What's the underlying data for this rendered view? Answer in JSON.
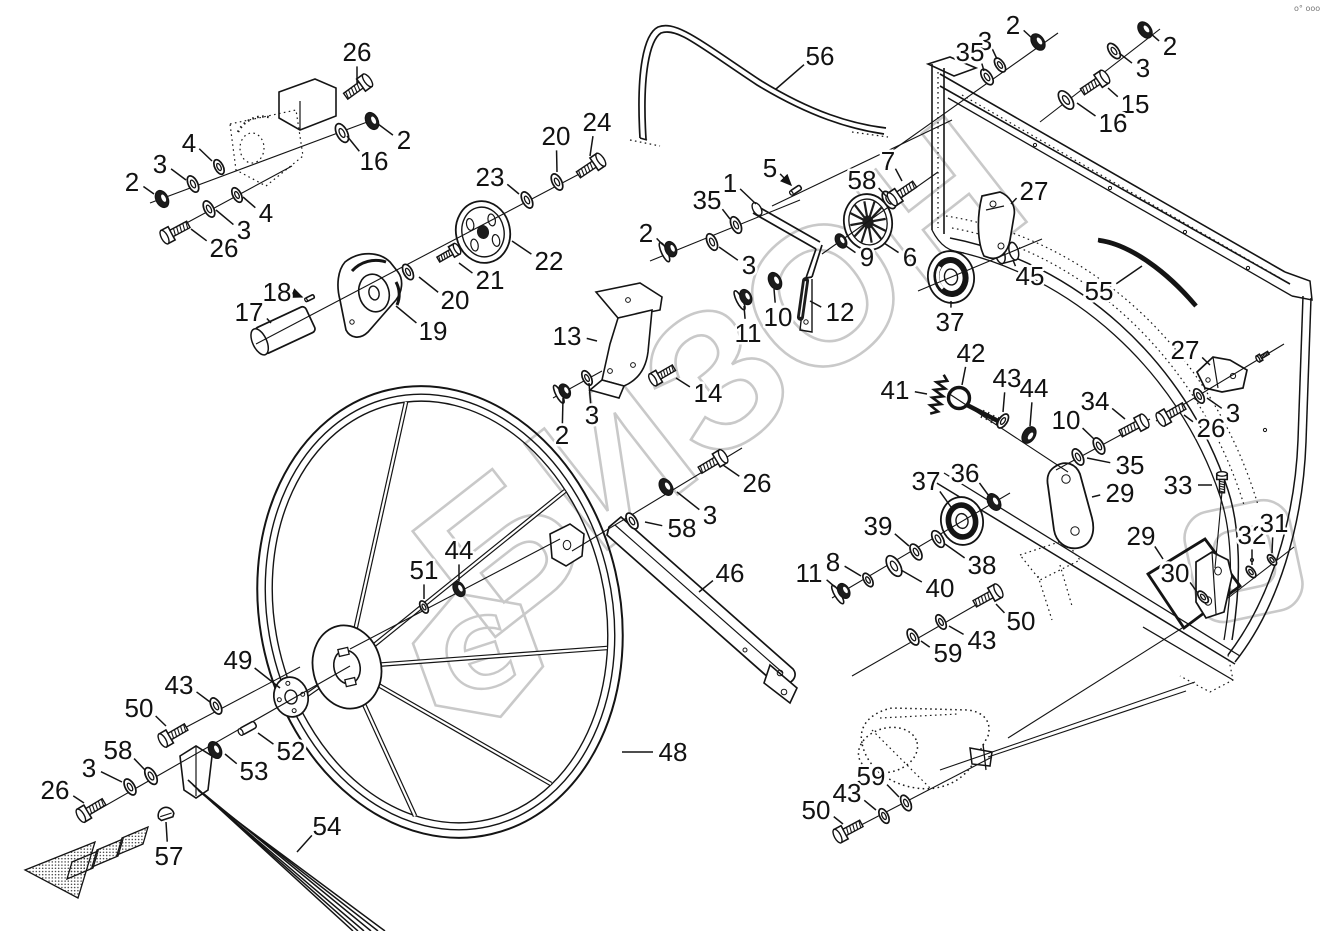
{
  "meta": {
    "type": "exploded-parts-diagram",
    "corner_mark": "o° ooo"
  },
  "watermark": {
    "text": "БИЗОН",
    "logo_glyph": "Є",
    "color": "#c9c9c9"
  },
  "colors": {
    "line": "#141414",
    "background": "#ffffff"
  },
  "labels": [
    {
      "t": "26",
      "x": 357,
      "y": 52,
      "px": 357,
      "py": 83
    },
    {
      "t": "2",
      "x": 404,
      "y": 140,
      "px": 378,
      "py": 124
    },
    {
      "t": "16",
      "x": 374,
      "y": 161,
      "px": 347,
      "py": 136
    },
    {
      "t": "4",
      "x": 189,
      "y": 143,
      "px": 212,
      "py": 161
    },
    {
      "t": "3",
      "x": 160,
      "y": 164,
      "px": 186,
      "py": 180
    },
    {
      "t": "2",
      "x": 132,
      "y": 182,
      "px": 154,
      "py": 194
    },
    {
      "t": "4",
      "x": 266,
      "y": 213,
      "px": 243,
      "py": 197
    },
    {
      "t": "3",
      "x": 244,
      "y": 230,
      "px": 216,
      "py": 210
    },
    {
      "t": "26",
      "x": 224,
      "y": 248,
      "px": 191,
      "py": 229
    },
    {
      "t": "17",
      "x": 249,
      "y": 312,
      "px": 271,
      "py": 323
    },
    {
      "t": "18",
      "x": 277,
      "y": 292,
      "px": 302,
      "py": 297,
      "arrow": true
    },
    {
      "t": "19",
      "x": 433,
      "y": 331,
      "px": 396,
      "py": 306
    },
    {
      "t": "20",
      "x": 455,
      "y": 300,
      "px": 419,
      "py": 277
    },
    {
      "t": "21",
      "x": 490,
      "y": 280,
      "px": 459,
      "py": 263
    },
    {
      "t": "22",
      "x": 549,
      "y": 261,
      "px": 512,
      "py": 241
    },
    {
      "t": "23",
      "x": 490,
      "y": 177,
      "px": 519,
      "py": 194
    },
    {
      "t": "20",
      "x": 556,
      "y": 136,
      "px": 557,
      "py": 172
    },
    {
      "t": "24",
      "x": 597,
      "y": 122,
      "px": 590,
      "py": 156
    },
    {
      "t": "56",
      "x": 820,
      "y": 56,
      "px": 776,
      "py": 89
    },
    {
      "t": "1",
      "x": 730,
      "y": 183,
      "px": 756,
      "py": 204
    },
    {
      "t": "5",
      "x": 770,
      "y": 168,
      "px": 791,
      "py": 185,
      "arrow": true
    },
    {
      "t": "35",
      "x": 707,
      "y": 200,
      "px": 730,
      "py": 219
    },
    {
      "t": "2",
      "x": 646,
      "y": 233,
      "px": 663,
      "py": 245
    },
    {
      "t": "3",
      "x": 749,
      "y": 265,
      "px": 719,
      "py": 247
    },
    {
      "t": "13",
      "x": 567,
      "y": 336,
      "px": 597,
      "py": 341
    },
    {
      "t": "14",
      "x": 708,
      "y": 393,
      "px": 676,
      "py": 378
    },
    {
      "t": "3",
      "x": 592,
      "y": 415,
      "px": 589,
      "py": 383
    },
    {
      "t": "2",
      "x": 562,
      "y": 435,
      "px": 563,
      "py": 398
    },
    {
      "t": "10",
      "x": 778,
      "y": 317,
      "px": 774,
      "py": 289
    },
    {
      "t": "11",
      "x": 748,
      "y": 333,
      "px": 744,
      "py": 306
    },
    {
      "t": "12",
      "x": 840,
      "y": 312,
      "px": 810,
      "py": 301
    },
    {
      "t": "58",
      "x": 862,
      "y": 180,
      "px": 886,
      "py": 196
    },
    {
      "t": "7",
      "x": 888,
      "y": 161,
      "px": 902,
      "py": 181
    },
    {
      "t": "9",
      "x": 867,
      "y": 257,
      "px": 846,
      "py": 246
    },
    {
      "t": "6",
      "x": 910,
      "y": 257,
      "px": 884,
      "py": 243
    },
    {
      "t": "37",
      "x": 950,
      "y": 322,
      "px": 951,
      "py": 301
    },
    {
      "t": "45",
      "x": 1030,
      "y": 276,
      "px": 1013,
      "py": 260
    },
    {
      "t": "27",
      "x": 1034,
      "y": 191,
      "px": 1011,
      "py": 204
    },
    {
      "t": "55",
      "x": 1099,
      "y": 291,
      "px": 1142,
      "py": 266
    },
    {
      "t": "2",
      "x": 1013,
      "y": 25,
      "px": 1033,
      "py": 39
    },
    {
      "t": "3",
      "x": 985,
      "y": 41,
      "px": 997,
      "py": 59
    },
    {
      "t": "35",
      "x": 970,
      "y": 52,
      "px": 984,
      "py": 71
    },
    {
      "t": "2",
      "x": 1170,
      "y": 46,
      "px": 1150,
      "py": 33
    },
    {
      "t": "3",
      "x": 1143,
      "y": 68,
      "px": 1119,
      "py": 53
    },
    {
      "t": "15",
      "x": 1135,
      "y": 104,
      "px": 1108,
      "py": 88
    },
    {
      "t": "16",
      "x": 1113,
      "y": 123,
      "px": 1077,
      "py": 103
    },
    {
      "t": "41",
      "x": 895,
      "y": 390,
      "px": 927,
      "py": 394
    },
    {
      "t": "42",
      "x": 971,
      "y": 353,
      "px": 962,
      "py": 385
    },
    {
      "t": "43",
      "x": 1007,
      "y": 378,
      "px": 1003,
      "py": 412
    },
    {
      "t": "44",
      "x": 1034,
      "y": 388,
      "px": 1030,
      "py": 426
    },
    {
      "t": "34",
      "x": 1095,
      "y": 401,
      "px": 1125,
      "py": 419
    },
    {
      "t": "10",
      "x": 1066,
      "y": 420,
      "px": 1094,
      "py": 439
    },
    {
      "t": "35",
      "x": 1130,
      "y": 465,
      "px": 1087,
      "py": 458
    },
    {
      "t": "36",
      "x": 965,
      "y": 473,
      "px": 989,
      "py": 496
    },
    {
      "t": "37",
      "x": 926,
      "y": 481,
      "px": 951,
      "py": 507
    },
    {
      "t": "29",
      "x": 1120,
      "y": 493,
      "px": 1092,
      "py": 497
    },
    {
      "t": "33",
      "x": 1178,
      "y": 485,
      "px": 1212,
      "py": 485
    },
    {
      "t": "27",
      "x": 1185,
      "y": 350,
      "px": 1210,
      "py": 365
    },
    {
      "t": "3",
      "x": 1233,
      "y": 413,
      "px": 1207,
      "py": 398
    },
    {
      "t": "26",
      "x": 1211,
      "y": 428,
      "px": 1184,
      "py": 415
    },
    {
      "t": "39",
      "x": 878,
      "y": 526,
      "px": 909,
      "py": 546
    },
    {
      "t": "38",
      "x": 982,
      "y": 565,
      "px": 945,
      "py": 544
    },
    {
      "t": "40",
      "x": 940,
      "y": 588,
      "px": 901,
      "py": 570
    },
    {
      "t": "8",
      "x": 833,
      "y": 562,
      "px": 861,
      "py": 576
    },
    {
      "t": "11",
      "x": 809,
      "y": 573,
      "px": 835,
      "py": 587
    },
    {
      "t": "50",
      "x": 1021,
      "y": 621,
      "px": 996,
      "py": 604
    },
    {
      "t": "43",
      "x": 982,
      "y": 640,
      "px": 949,
      "py": 626
    },
    {
      "t": "59",
      "x": 948,
      "y": 653,
      "px": 921,
      "py": 641
    },
    {
      "t": "29",
      "x": 1141,
      "y": 536,
      "px": 1163,
      "py": 559
    },
    {
      "t": "30",
      "x": 1175,
      "y": 573,
      "px": 1197,
      "py": 592
    },
    {
      "t": "32",
      "x": 1252,
      "y": 535,
      "px": 1252,
      "py": 565
    },
    {
      "t": "31",
      "x": 1274,
      "y": 523,
      "px": 1272,
      "py": 553
    },
    {
      "t": "51",
      "x": 424,
      "y": 570,
      "px": 424,
      "py": 599
    },
    {
      "t": "44",
      "x": 459,
      "y": 550,
      "px": 459,
      "py": 581
    },
    {
      "t": "58",
      "x": 682,
      "y": 528,
      "px": 645,
      "py": 522
    },
    {
      "t": "3",
      "x": 710,
      "y": 515,
      "px": 677,
      "py": 492
    },
    {
      "t": "26",
      "x": 757,
      "y": 483,
      "px": 723,
      "py": 465
    },
    {
      "t": "46",
      "x": 730,
      "y": 573,
      "px": 699,
      "py": 592
    },
    {
      "t": "48",
      "x": 673,
      "y": 752,
      "px": 622,
      "py": 752
    },
    {
      "t": "49",
      "x": 238,
      "y": 660,
      "px": 280,
      "py": 688
    },
    {
      "t": "43",
      "x": 179,
      "y": 685,
      "px": 210,
      "py": 702
    },
    {
      "t": "50",
      "x": 139,
      "y": 708,
      "px": 166,
      "py": 726
    },
    {
      "t": "58",
      "x": 118,
      "y": 750,
      "px": 145,
      "py": 770
    },
    {
      "t": "3",
      "x": 89,
      "y": 768,
      "px": 122,
      "py": 782
    },
    {
      "t": "26",
      "x": 55,
      "y": 790,
      "px": 84,
      "py": 803
    },
    {
      "t": "52",
      "x": 291,
      "y": 751,
      "px": 258,
      "py": 733
    },
    {
      "t": "53",
      "x": 254,
      "y": 771,
      "px": 225,
      "py": 754
    },
    {
      "t": "57",
      "x": 169,
      "y": 856,
      "px": 166,
      "py": 822
    },
    {
      "t": "54",
      "x": 327,
      "y": 826,
      "px": 297,
      "py": 852
    },
    {
      "t": "59",
      "x": 871,
      "y": 776,
      "px": 899,
      "py": 797
    },
    {
      "t": "43",
      "x": 847,
      "y": 793,
      "px": 876,
      "py": 810
    },
    {
      "t": "50",
      "x": 816,
      "y": 810,
      "px": 843,
      "py": 824
    }
  ],
  "axes": [
    [
      150,
      203,
      378,
      118
    ],
    [
      168,
      233,
      292,
      166
    ],
    [
      256,
      344,
      604,
      161
    ],
    [
      650,
      261,
      800,
      200
    ],
    [
      772,
      206,
      952,
      120
    ],
    [
      822,
      254,
      938,
      172
    ],
    [
      918,
      291,
      1042,
      239
    ],
    [
      893,
      150,
      1058,
      33
    ],
    [
      1040,
      122,
      1160,
      29
    ],
    [
      948,
      393,
      1068,
      472
    ],
    [
      1056,
      470,
      1150,
      419
    ],
    [
      832,
      598,
      1010,
      493
    ],
    [
      852,
      676,
      1002,
      590
    ],
    [
      1008,
      738,
      1198,
      618
    ],
    [
      838,
      837,
      992,
      757
    ],
    [
      988,
      757,
      1186,
      691
    ],
    [
      940,
      770,
      1195,
      682
    ],
    [
      82,
      819,
      350,
      666
    ],
    [
      160,
      741,
      300,
      667
    ],
    [
      350,
      649,
      560,
      539
    ],
    [
      572,
      551,
      742,
      448
    ],
    [
      553,
      398,
      602,
      371
    ],
    [
      1222,
      492,
      1215,
      568
    ],
    [
      1228,
      598,
      1294,
      547
    ],
    [
      1156,
      421,
      1284,
      344
    ]
  ],
  "hardware": [
    {
      "k": "n",
      "x": 162,
      "y": 199,
      "a": -27
    },
    {
      "k": "w",
      "x": 193,
      "y": 184,
      "a": -27
    },
    {
      "k": "w",
      "x": 219,
      "y": 167,
      "a": -27,
      "s": 0.9
    },
    {
      "k": "w",
      "x": 342,
      "y": 133,
      "a": -27,
      "s": 1.15
    },
    {
      "k": "n",
      "x": 372,
      "y": 121,
      "a": -27
    },
    {
      "k": "b",
      "x": 357,
      "y": 88,
      "a": 144
    },
    {
      "k": "b",
      "x": 176,
      "y": 231,
      "a": -28
    },
    {
      "k": "w",
      "x": 209,
      "y": 209,
      "a": -28
    },
    {
      "k": "w",
      "x": 237,
      "y": 195,
      "a": -28,
      "s": 0.9
    },
    {
      "k": "w",
      "x": 408,
      "y": 272,
      "a": -28,
      "s": 0.95
    },
    {
      "k": "b",
      "x": 448,
      "y": 254,
      "a": 150,
      "s": 0.8
    },
    {
      "k": "w",
      "x": 527,
      "y": 200,
      "a": -28
    },
    {
      "k": "w",
      "x": 557,
      "y": 182,
      "a": -28
    },
    {
      "k": "b",
      "x": 590,
      "y": 167,
      "a": 146
    },
    {
      "k": "f",
      "x": 669,
      "y": 250,
      "a": -25
    },
    {
      "k": "w",
      "x": 712,
      "y": 242,
      "a": -25
    },
    {
      "k": "w",
      "x": 736,
      "y": 225,
      "a": -25
    },
    {
      "k": "f",
      "x": 563,
      "y": 392,
      "a": -28,
      "s": 0.95
    },
    {
      "k": "w",
      "x": 587,
      "y": 378,
      "a": -28,
      "s": 0.9
    },
    {
      "k": "b",
      "x": 663,
      "y": 374,
      "a": -30,
      "s": 0.9
    },
    {
      "k": "n",
      "x": 775,
      "y": 281,
      "a": -27
    },
    {
      "k": "f",
      "x": 744,
      "y": 298,
      "a": -27
    },
    {
      "k": "p",
      "x": 796,
      "y": 190,
      "a": -34,
      "s": 0.7
    },
    {
      "k": "p",
      "x": 310,
      "y": 298,
      "a": -26,
      "s": 0.55
    },
    {
      "k": "sp",
      "x": 803,
      "y": 299
    },
    {
      "k": "w",
      "x": 889,
      "y": 200,
      "a": -33,
      "s": 1.1
    },
    {
      "k": "b",
      "x": 903,
      "y": 192,
      "a": -34
    },
    {
      "k": "n",
      "x": 841,
      "y": 241,
      "a": -30,
      "s": 0.85
    },
    {
      "k": "w",
      "x": 987,
      "y": 77,
      "a": -34
    },
    {
      "k": "w",
      "x": 1000,
      "y": 65,
      "a": -34,
      "s": 0.9
    },
    {
      "k": "n",
      "x": 1038,
      "y": 42,
      "a": -34
    },
    {
      "k": "w",
      "x": 1066,
      "y": 100,
      "a": -36,
      "s": 1.2
    },
    {
      "k": "b",
      "x": 1094,
      "y": 84,
      "a": 146
    },
    {
      "k": "w",
      "x": 1114,
      "y": 51,
      "a": -36
    },
    {
      "k": "n",
      "x": 1145,
      "y": 30,
      "a": -36
    },
    {
      "k": "w",
      "x": 1003,
      "y": 421,
      "a": 33,
      "s": 0.9
    },
    {
      "k": "n",
      "x": 1029,
      "y": 435,
      "a": 33
    },
    {
      "k": "w",
      "x": 1078,
      "y": 457,
      "a": -28
    },
    {
      "k": "w",
      "x": 1099,
      "y": 446,
      "a": -28
    },
    {
      "k": "b",
      "x": 1133,
      "y": 427,
      "a": 152
    },
    {
      "k": "coil",
      "x": 938,
      "y": 396,
      "a": 105
    },
    {
      "k": "n",
      "x": 994,
      "y": 502,
      "a": -31
    },
    {
      "k": "f",
      "x": 842,
      "y": 592,
      "a": -31
    },
    {
      "k": "w",
      "x": 868,
      "y": 580,
      "a": -31,
      "s": 0.85
    },
    {
      "k": "w",
      "x": 894,
      "y": 566,
      "a": -31,
      "s": 1.3
    },
    {
      "k": "w",
      "x": 916,
      "y": 552,
      "a": -31
    },
    {
      "k": "w",
      "x": 938,
      "y": 539,
      "a": -31,
      "s": 1.05
    },
    {
      "k": "w",
      "x": 913,
      "y": 637,
      "a": -29
    },
    {
      "k": "w",
      "x": 941,
      "y": 622,
      "a": -29,
      "s": 0.9
    },
    {
      "k": "b",
      "x": 987,
      "y": 597,
      "a": 151
    },
    {
      "k": "b",
      "x": 1222,
      "y": 483,
      "a": 90,
      "s": 0.7
    },
    {
      "k": "w",
      "x": 1251,
      "y": 572,
      "a": -38,
      "s": 0.75
    },
    {
      "k": "w",
      "x": 1272,
      "y": 560,
      "a": -38,
      "s": 0.7
    },
    {
      "k": "w",
      "x": 1203,
      "y": 597,
      "a": -40,
      "s": 0.8
    },
    {
      "k": "b",
      "x": 1172,
      "y": 413,
      "a": -30
    },
    {
      "k": "w",
      "x": 1199,
      "y": 396,
      "a": -30,
      "s": 0.9
    },
    {
      "k": "b",
      "x": 1263,
      "y": 356,
      "a": -31,
      "s": 0.45
    },
    {
      "k": "b",
      "x": 849,
      "y": 830,
      "a": -28
    },
    {
      "k": "w",
      "x": 884,
      "y": 816,
      "a": -27,
      "s": 0.9
    },
    {
      "k": "w",
      "x": 906,
      "y": 803,
      "a": -27,
      "s": 0.95
    },
    {
      "k": "b",
      "x": 92,
      "y": 809,
      "a": -31
    },
    {
      "k": "w",
      "x": 130,
      "y": 787,
      "a": -30
    },
    {
      "k": "w",
      "x": 151,
      "y": 776,
      "a": -30,
      "s": 1.05
    },
    {
      "k": "b",
      "x": 174,
      "y": 734,
      "a": -30
    },
    {
      "k": "w",
      "x": 216,
      "y": 706,
      "a": -28
    },
    {
      "k": "n",
      "x": 215,
      "y": 750,
      "a": -28
    },
    {
      "k": "p",
      "x": 248,
      "y": 728,
      "a": -29,
      "s": 1.05
    },
    {
      "k": "plug",
      "x": 165,
      "y": 812,
      "a": -18
    },
    {
      "k": "w",
      "x": 424,
      "y": 607,
      "a": -28,
      "s": 0.75
    },
    {
      "k": "n",
      "x": 459,
      "y": 589,
      "a": -28,
      "s": 0.9
    },
    {
      "k": "w",
      "x": 632,
      "y": 521,
      "a": -31
    },
    {
      "k": "n",
      "x": 666,
      "y": 487,
      "a": -31
    },
    {
      "k": "b",
      "x": 712,
      "y": 463,
      "a": 149
    }
  ]
}
